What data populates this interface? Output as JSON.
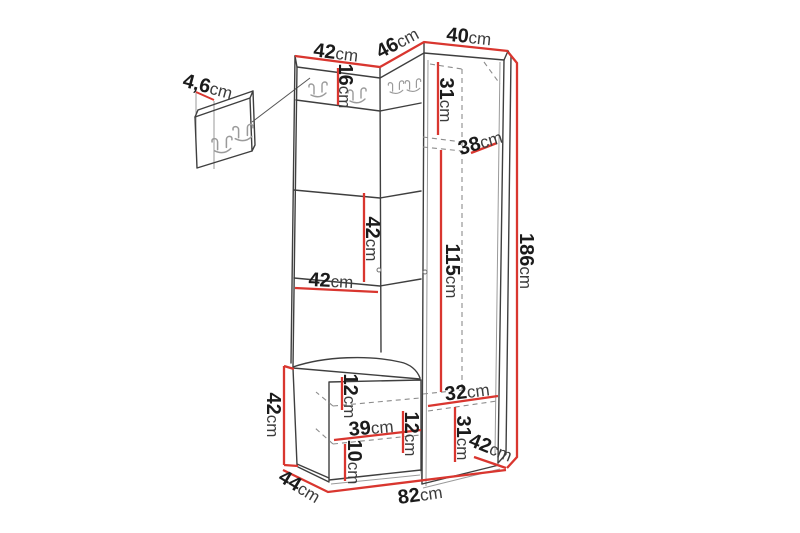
{
  "colors": {
    "background": "#ffffff",
    "dimension_red": "#d9362f",
    "outline_gray": "#3f3f3f",
    "secondary_gray": "#8c8c8c",
    "hook_gray": "#9a9a9a",
    "number_black": "#1b1b1b"
  },
  "labels": [
    {
      "name": "panel-depth",
      "num": "4,6",
      "unit": "cm"
    },
    {
      "name": "top-width-left",
      "num": "42",
      "unit": "cm"
    },
    {
      "name": "top-width-middle",
      "num": "46",
      "unit": "cm"
    },
    {
      "name": "top-width-right",
      "num": "40",
      "unit": "cm"
    },
    {
      "name": "hook-strip-height",
      "num": "16",
      "unit": "cm"
    },
    {
      "name": "wardrobe-top-section-height",
      "num": "31",
      "unit": "cm"
    },
    {
      "name": "wardrobe-upper-depth",
      "num": "38",
      "unit": "cm"
    },
    {
      "name": "wardrobe-interior-height",
      "num": "115",
      "unit": "cm"
    },
    {
      "name": "total-height",
      "num": "186",
      "unit": "cm"
    },
    {
      "name": "panel-section-height",
      "num": "42",
      "unit": "cm"
    },
    {
      "name": "panel-section-width",
      "num": "42",
      "unit": "cm"
    },
    {
      "name": "bench-height",
      "num": "42",
      "unit": "cm"
    },
    {
      "name": "bench-top-inset",
      "num": "12",
      "unit": "cm"
    },
    {
      "name": "bench-interior-width",
      "num": "39",
      "unit": "cm"
    },
    {
      "name": "bench-mid-inset",
      "num": "12",
      "unit": "cm"
    },
    {
      "name": "bench-plinth-height",
      "num": "10",
      "unit": "cm"
    },
    {
      "name": "wardrobe-interior-width",
      "num": "32",
      "unit": "cm"
    },
    {
      "name": "wardrobe-bottom-section-height",
      "num": "31",
      "unit": "cm"
    },
    {
      "name": "wardrobe-depth",
      "num": "42",
      "unit": "cm"
    },
    {
      "name": "bench-depth",
      "num": "44",
      "unit": "cm"
    },
    {
      "name": "total-width",
      "num": "82",
      "unit": "cm"
    }
  ]
}
